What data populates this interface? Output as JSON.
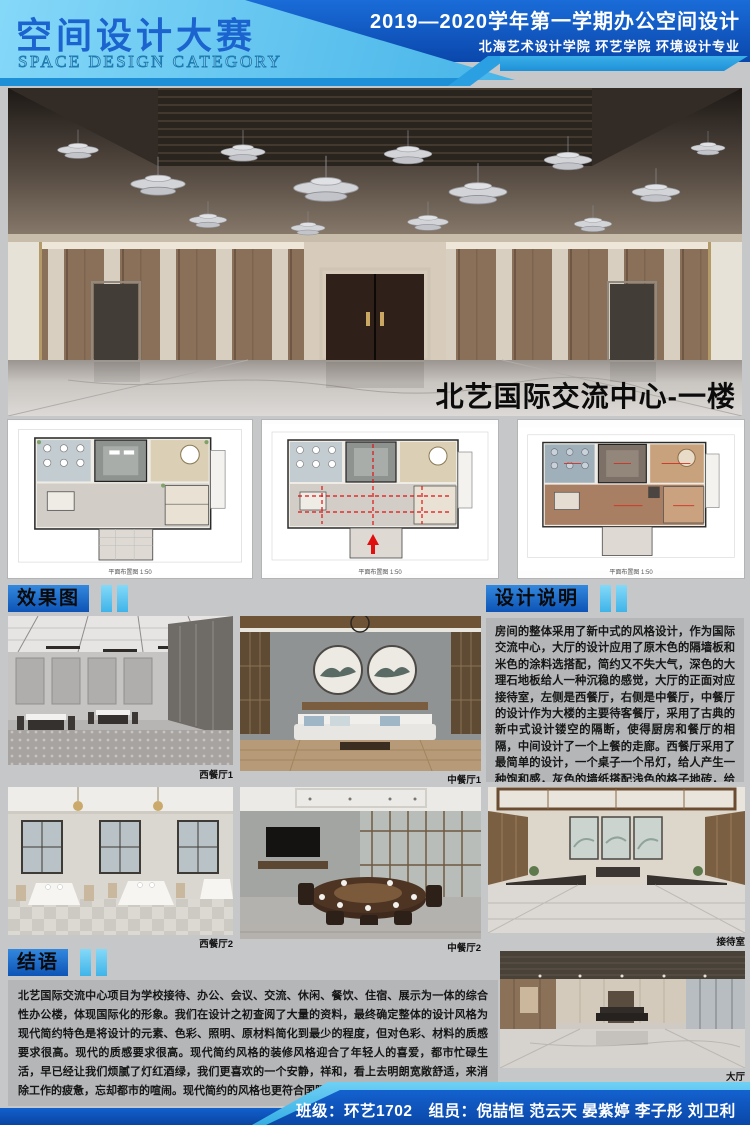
{
  "header": {
    "title": "空间设计大赛",
    "subtitle": "SPACE DESIGN CATEGORY",
    "term": "2019—2020学年第一学期办公空间设计",
    "department": "北海艺术设计学院 环艺学院 环境设计专业"
  },
  "hero": {
    "caption": "北艺国际交流中心-一楼"
  },
  "plans": [
    {
      "caption": "平面布置图 1:50"
    },
    {
      "caption": "平面布置图 1:50"
    },
    {
      "caption": "平面布置图 1:50"
    }
  ],
  "sections": {
    "effects_title": "效果图",
    "notes_title": "设计说明",
    "conclusion_title": "结语"
  },
  "photos": [
    {
      "label": "西餐厅1"
    },
    {
      "label": "中餐厅1"
    },
    {
      "label": "西餐厅2"
    },
    {
      "label": "中餐厅2"
    },
    {
      "label": "接待室"
    },
    {
      "label": "大厅"
    }
  ],
  "notes_text": "房间的整体采用了新中式的风格设计，作为国际交流中心，大厅的设计应用了原木色的隔墙板和米色的涂料选搭配，简约又不失大气，深色的大理石地板给人一种沉稳的感觉，大厅的正面对应接待室，左侧是西餐厅，右侧是中餐厅，中餐厅的设计作为大楼的主要待客餐厅，采用了古典的新中式设计镂空的隔断，使得厨房和餐厅的相隔，中间设计了一个上餐的走廊。西餐厅采用了最简单的设计，一个桌子一个吊灯，给人产生一种饱和感，灰色的墙纸搭配浅色的格子地砖，给用餐人员营造一种轻松的预的用餐环境。",
  "conclusion_text": "北艺国际交流中心项目为学校接待、办公、会议、交流、休闲、餐饮、住宿、展示为一体的综合性办公楼，体现国际化的形象。我们在设计之初查阅了大量的资料，最终确定整体的设计风格为现代简约特色是将设计的元素、色彩、照明、原材料简化到最少的程度，但对色彩、材料的质感要求很高。现代的质感要求很高。现代简约风格的装修风格迎合了年轻人的喜爱，都市忙碌生活，早已经让我们烦腻了灯红酒绿，我们更喜欢的一个安静，祥和，看上去明朗宽敞舒适，来消除工作的疲惫，忘却都市的喧闹。现代简约的风格也更符合国际化的需求。",
  "footer": {
    "class_label": "班级：",
    "class_value": "环艺1702",
    "members_label": "组员：",
    "members": "倪喆恒 范云天 晏紫婷 李子彤 刘卫利"
  },
  "colors": {
    "accent_blue": "#0d54b6",
    "light_blue": "#5ec7f2",
    "cyan_bar": "#49c0ee",
    "panel_gray": "#b4b6b8"
  }
}
